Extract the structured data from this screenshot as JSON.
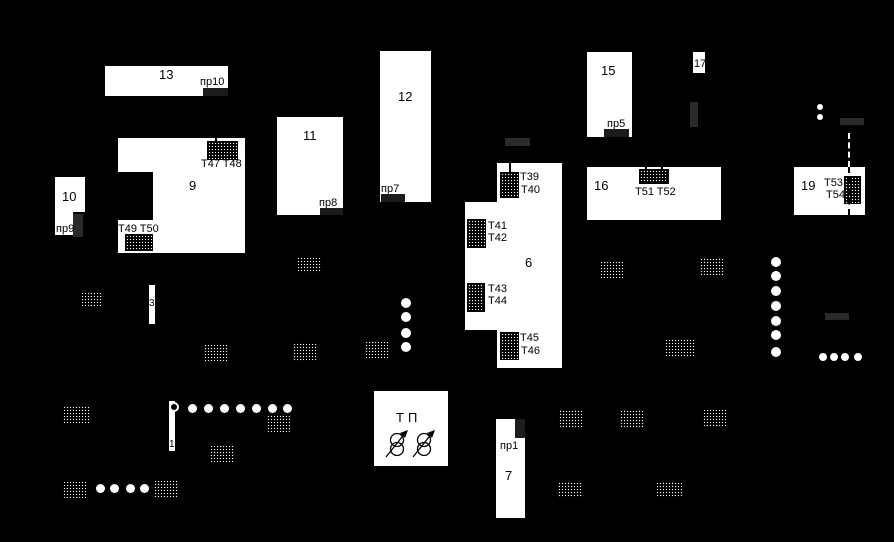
{
  "diagram": {
    "type": "site-plan-mnemonic",
    "colors": {
      "background": "#000000",
      "building": "#ffffff",
      "text": "#000000",
      "dark_bar_on_white": "#1c1c1c",
      "dark_bar_on_black": "#2a2a2a"
    }
  },
  "buildings": {
    "b13": {
      "number": "13",
      "gate": "пр10"
    },
    "b10": {
      "number": "10",
      "gate": "пр9"
    },
    "b9": {
      "number": "9",
      "t_top": "T47 T48",
      "t_bottom": "T49 T50"
    },
    "b11": {
      "number": "11",
      "gate": "пр8"
    },
    "b12": {
      "number": "12",
      "gate": "пр7"
    },
    "b6": {
      "number": "6",
      "t39": "T39",
      "t40": "T40",
      "t41": "T41",
      "t42": "T42",
      "t43": "T43",
      "t44": "T44",
      "t45": "T45",
      "t46": "T46"
    },
    "b15": {
      "number": "15",
      "gate": "пр5"
    },
    "b17": {
      "number": "17"
    },
    "b16": {
      "number": "16",
      "t": "T51 T52"
    },
    "b19": {
      "number": "19",
      "t53": "T53",
      "t54": "T54"
    },
    "b7": {
      "number": "7",
      "gate": "пр1"
    },
    "tp": {
      "label": "ТП"
    }
  },
  "lines": {
    "line3": "3",
    "line1": "1"
  }
}
